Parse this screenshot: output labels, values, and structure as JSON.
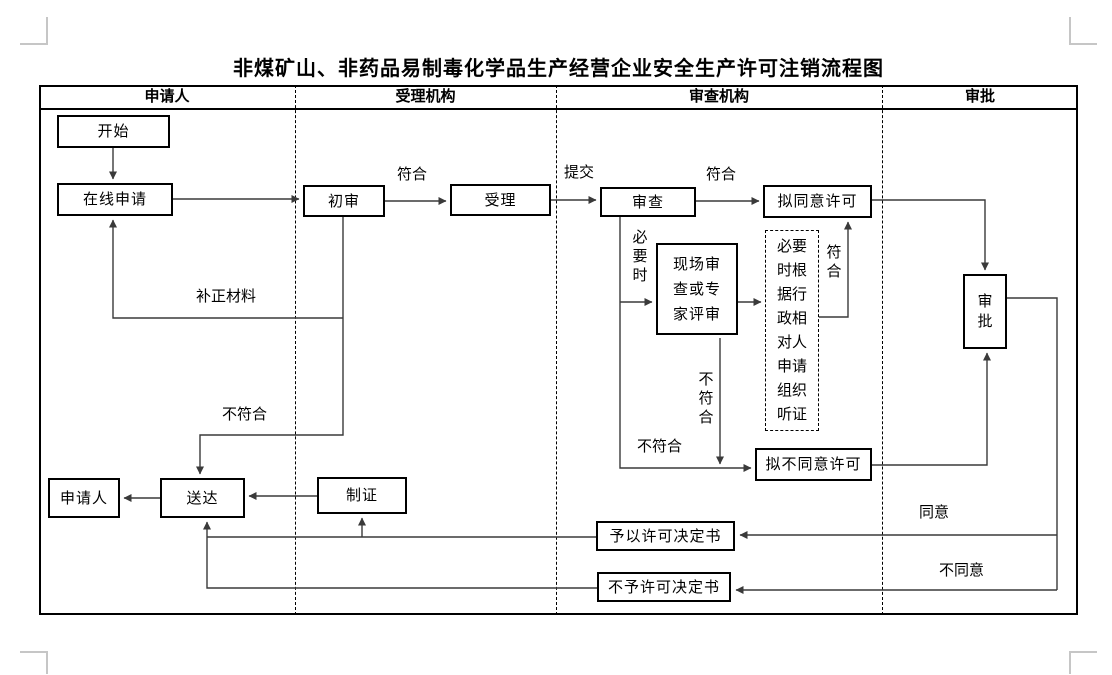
{
  "page": {
    "title": "非煤矿山、非药品易制毒化学品生产经营企业安全生产许可注销流程图"
  },
  "lanes": [
    {
      "label": "申请人"
    },
    {
      "label": "受理机构"
    },
    {
      "label": "审查机构"
    },
    {
      "label": "审批"
    }
  ],
  "nodes": {
    "start": "开始",
    "online_apply": "在线申请",
    "preliminary_review": "初审",
    "accept": "受理",
    "review": "审查",
    "propose_approve": "拟同意许可",
    "onsite_review": "现场审查或专家评审",
    "hearing": "必要时根据行政相对人申请组织听证",
    "propose_deny": "拟不同意许可",
    "approve": "审批",
    "applicant": "申请人",
    "deliver": "送达",
    "make_certificate": "制证",
    "grant_decision": "予以许可决定书",
    "deny_decision": "不予许可决定书"
  },
  "edge_labels": {
    "pass_preliminary": "符合",
    "submit": "提交",
    "pass_review": "符合",
    "when_necessary": "必要时",
    "pass_hearing": "符合",
    "fail_onsite": "不符合",
    "fail_review": "不符合",
    "supplement_materials": "补正材料",
    "fail_preliminary": "不符合",
    "agree": "同意",
    "disagree": "不同意"
  },
  "colors": {
    "line": "#3a3a3a",
    "border": "#000000",
    "corner_mark": "#c6c6c6",
    "background": "#ffffff"
  }
}
